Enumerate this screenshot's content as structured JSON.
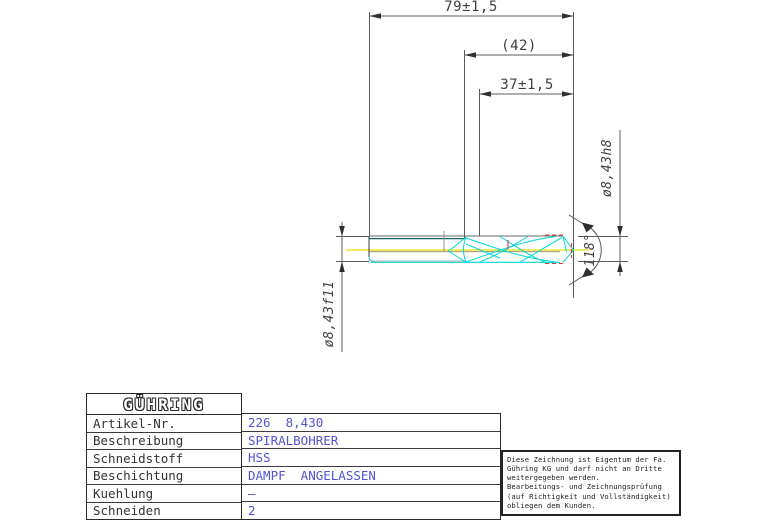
{
  "drawing": {
    "dim_overall_length": "79±1,5",
    "dim_flute_length": "(42)",
    "dim_usable_length": "37±1,5",
    "dim_shank_diameter": "ø8,43f11",
    "dim_body_diameter": "ø8,43h8",
    "dim_point_angle": "118°"
  },
  "colors": {
    "drill_cyan": "#00d8d8",
    "drill_teal": "#1a6868",
    "centerline_yellow": "#e6df00",
    "tolerance_red": "#e53535",
    "dimension_gray": "#5c5c5c",
    "value_blue": "#5353d4"
  },
  "title_block": {
    "logo": "GÜHRING",
    "rows": [
      {
        "label": "Artikel-Nr.",
        "value": "226  8,430"
      },
      {
        "label": "Beschreibung",
        "value": "SPIRALBOHRER"
      },
      {
        "label": "Schneidstoff",
        "value": "HSS"
      },
      {
        "label": "Beschichtung",
        "value": "DAMPF  ANGELASSEN"
      },
      {
        "label": "Kuehlung",
        "value": "–"
      },
      {
        "label": "Schneiden",
        "value": "2"
      }
    ]
  },
  "disclaimer": {
    "lines": [
      "Diese Zeichnung ist Eigentum der Fa.",
      "Gühring KG und darf nicht an Dritte",
      "weitergegeben werden.",
      "Bearbeitungs- und Zeichnungsprüfung",
      "(auf Richtigkeit und Vollständigkeit)",
      "obliegen dem Kunden."
    ]
  }
}
